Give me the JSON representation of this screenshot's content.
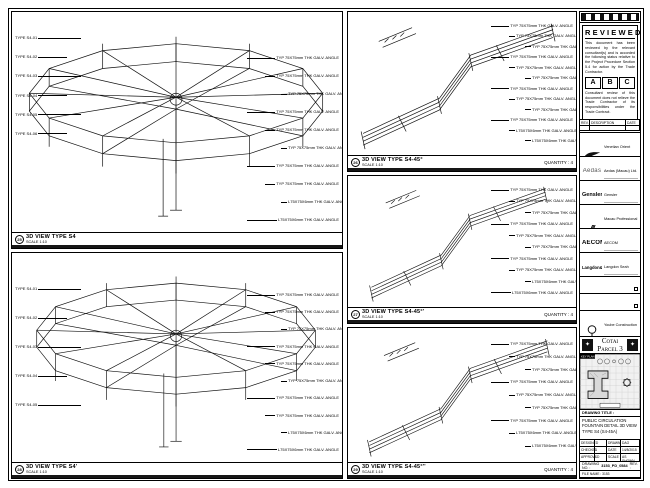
{
  "sheet": {
    "line_color": "#111111",
    "bg": "#ffffff"
  },
  "panels": {
    "s4": {
      "num": "25",
      "title": "3D VIEW TYPE S4",
      "scale": "SCALE 1:10",
      "left_labels": [
        "TYPE S4-01",
        "TYPE S4-02",
        "TYPE S4-03",
        "TYPE S4-04",
        "TYPE S4-05",
        "TYPE S4-06"
      ],
      "right_labels": [
        "TYP 75X75mm THK GALV. ANGLE",
        "TYP 75X75mm THK GALV. ANGLE",
        "TYP 75X75mm THK GALV. ANGLE",
        "TYP 75X75mm THK GALV. ANGLE",
        "TYP 75X75mm THK GALV. ANGLE",
        "TYP 75X75mm THK GALV. ANGLE",
        "TYP 75X75mm THK GALV. ANGLE",
        "TYP 75X75mm THK GALV. ANGLE",
        "L75X75X6mm THK GALV. ANGLE",
        "L75X75X6mm THK GALV. ANGLE"
      ]
    },
    "s4p": {
      "num": "28",
      "title": "3D VIEW TYPE S4'",
      "scale": "SCALE 1:10",
      "left_labels": [
        "TYPE S4-01",
        "TYPE S4-02",
        "TYPE S4-03",
        "TYPE S4-04",
        "TYPE S4-05"
      ],
      "right_labels": [
        "TYP 75X75mm THK GALV. ANGLE",
        "TYP 75X75mm THK GALV. ANGLE",
        "TYP 75X75mm THK GALV. ANGLE",
        "TYP 75X75mm THK GALV. ANGLE",
        "TYP 75X75mm THK GALV. ANGLE",
        "TYP 75X75mm THK GALV. ANGLE",
        "TYP 75X75mm THK GALV. ANGLE",
        "TYP 75X75mm THK GALV. ANGLE",
        "L75X75X6mm THK GALV. ANGLE",
        "L75X75X6mm THK GALV. ANGLE"
      ]
    },
    "s445": {
      "num": "26",
      "title": "3D VIEW TYPE S4-45°",
      "scale": "SCALE 1:10",
      "quantity": "QUANTITY : 4",
      "right_labels": [
        "TYP 75X75mm THK GALV. ANGLE",
        "TYP 75X75mm THK GALV. ANGLE",
        "TYP 75X75mm THK GALV. ANGLE",
        "TYP 75X75mm THK GALV. ANGLE",
        "TYP 75X75mm THK GALV. ANGLE",
        "TYP 75X75mm THK GALV. ANGLE",
        "TYP 75X75mm THK GALV. ANGLE",
        "TYP 75X75mm THK GALV. ANGLE",
        "TYP 75X75mm THK GALV. ANGLE",
        "TYP 75X75mm THK GALV. ANGLE",
        "L75X75X6mm THK GALV. ANGLE",
        "L75X75X6mm THK GALV. ANGLE"
      ]
    },
    "s445p": {
      "num": "27",
      "title": "3D VIEW TYPE S4-45°'",
      "scale": "SCALE 1:10",
      "quantity": "QUANTITY : 4",
      "right_labels": [
        "TYP 75X75mm THK GALV. ANGLE",
        "TYP 75X75mm THK GALV. ANGLE",
        "TYP 75X75mm THK GALV. ANGLE",
        "TYP 75X75mm THK GALV. ANGLE",
        "TYP 75X75mm THK GALV. ANGLE",
        "TYP 75X75mm THK GALV. ANGLE",
        "TYP 75X75mm THK GALV. ANGLE",
        "TYP 75X75mm THK GALV. ANGLE",
        "L75X75X6mm THK GALV. ANGLE",
        "L75X75X6mm THK GALV. ANGLE"
      ]
    },
    "s445pp": {
      "num": "29",
      "title": "3D VIEW TYPE S4-45°''",
      "scale": "SCALE 1:10",
      "quantity": "QUANTITY : 4",
      "right_labels": [
        "TYP 75X75mm THK GALV. ANGLE",
        "TYP 75X75mm THK GALV. ANGLE",
        "TYP 75X75mm THK GALV. ANGLE",
        "TYP 75X75mm THK GALV. ANGLE",
        "TYP 75X75mm THK GALV. ANGLE",
        "TYP 75X75mm THK GALV. ANGLE",
        "TYP 75X75mm THK GALV. ANGLE",
        "L75X75X6mm THK GALV. ANGLE",
        "L75X75X6mm THK GALV. ANGLE"
      ]
    }
  },
  "titleblock": {
    "reviewed": {
      "title": "REVIEWED",
      "p1": "This document has been reviewed by the relevant consultant(s) and is accorded the following status relative to the Project Procedure Section 5.4 for action by the Trade Contractor.",
      "cols": {
        "a": "A",
        "b": "B",
        "c": "C"
      },
      "p2": "Consultant review of this document does not relieve the Trade Contractor of its responsibilities under the Trade Contract.",
      "date_label": "Date :"
    },
    "rev_table": {
      "h1": "REV.",
      "h2": "DESCRIPTION",
      "h3": "DATE"
    },
    "consultants": {
      "c1": "Venetian Orient Limited",
      "c2": "Aedas (Macau) Ltd.",
      "c3": "Gensler",
      "c4": "Macau Professional Services Ltd.",
      "c5": "AECOM",
      "c6": "Langdon Seah"
    },
    "logos": {
      "aedas": "Aedas",
      "gensler": "Gensler",
      "mps": "///",
      "aecom": "AECOM",
      "langdon": "Langdon&Seah"
    },
    "contractor": "Yoube Construction (Macau) Co. Ltd.",
    "project": "Cotai Parcel 3",
    "keyplan_label": "KEY PLAN",
    "drawing_title_label": "DRAWING TITLE :",
    "drawing_title": "PUBLIC CIRCULATION FOUNTAIN DETAIL 3D VIEW TYPE S4 (S4-45A)",
    "info": {
      "r1c1": "DESIGNED",
      "r1c2": "",
      "r1c3": "DRAWN",
      "r1c4": "DAO",
      "r2c1": "CHECKED",
      "r2c2": "-",
      "r2c3": "DATE",
      "r2c4": "14/8/2015",
      "r3c1": "APPROVED",
      "r3c2": "-",
      "r3c3": "SCALE",
      "r3c4": "AS SHOWN"
    },
    "drawing_no_label": "DRAWING NO. :",
    "drawing_no": "3153_PD_0584",
    "rev_label": "REV. :",
    "rev": "A",
    "file1": "FILE NAME : 3153",
    "file2": "CAD FILE : B5_WORKING_DC_DRAWING"
  }
}
